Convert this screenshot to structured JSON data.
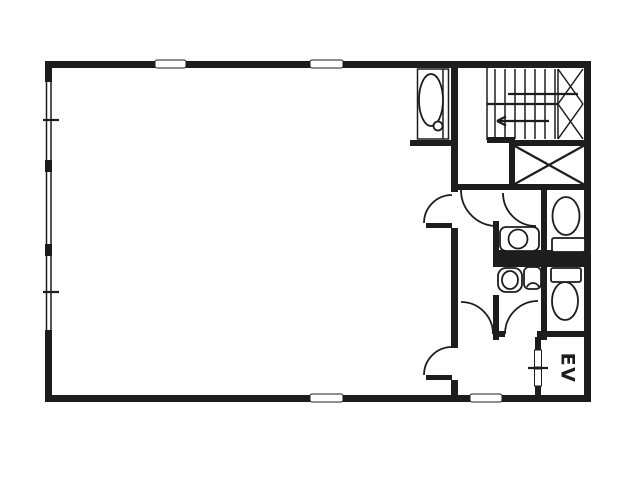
{
  "document": {
    "type": "architectural-floor-plan",
    "style": "black and white scanned line drawing"
  },
  "labels": {
    "elevator": "EV"
  },
  "colors": {
    "wall": "#1d1d1d",
    "background": "#ffffff"
  },
  "rooms": [
    {
      "name": "main-room",
      "note": "large open tenant room, left two thirds, no label"
    },
    {
      "name": "stairwell",
      "note": "u-shaped stair with treads, landing and up-arrow, top right"
    },
    {
      "name": "shaft",
      "note": "x-crossed shaft box below stair"
    },
    {
      "name": "utility-sink-closet",
      "note": "niche with slop sink at top wall"
    },
    {
      "name": "upper-washroom",
      "note": "alcove with round wash basin"
    },
    {
      "name": "upper-wc",
      "note": "water closet with toilet facing up"
    },
    {
      "name": "lower-washroom",
      "note": "alcove with basin and hand sink"
    },
    {
      "name": "lower-wc",
      "note": "water closet with toilet facing down"
    },
    {
      "name": "corridor",
      "note": "vertical corridor with swing doors"
    },
    {
      "name": "elevator-hall",
      "note": "hall in front of elevator"
    },
    {
      "name": "elevator",
      "label": "EV"
    }
  ]
}
